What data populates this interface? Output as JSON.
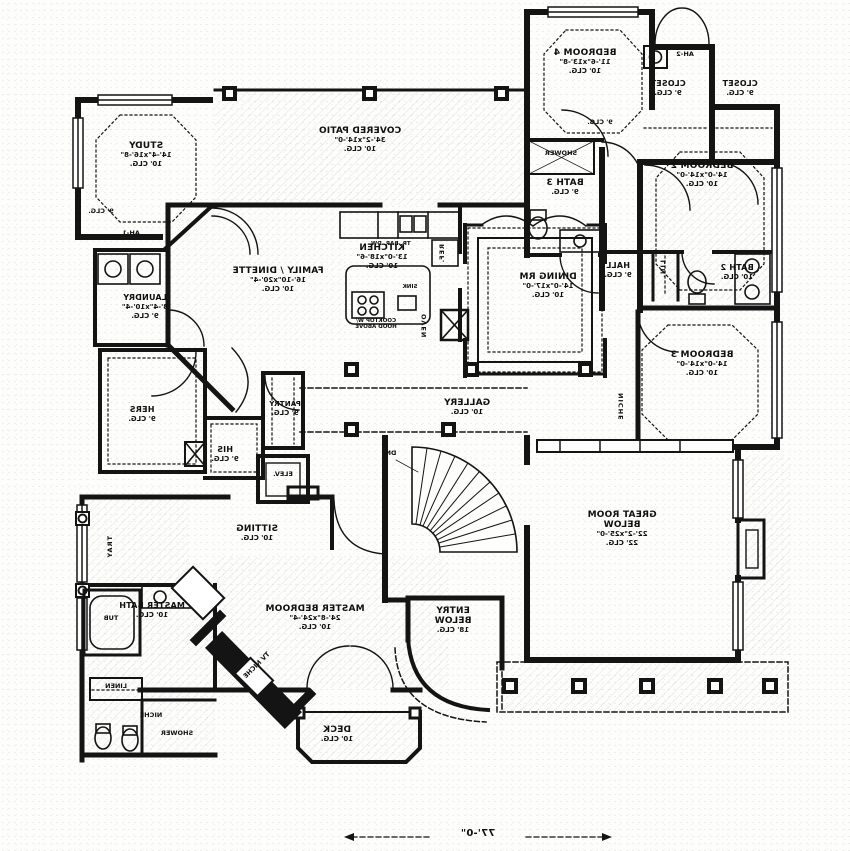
{
  "plan": {
    "rooms": [
      {
        "name": "BEDROOM 4",
        "size": "11'-6\"x13'-8\"",
        "clg": "10' CLG."
      },
      {
        "name": "CLOSET",
        "clg": "9' CLG."
      },
      {
        "name": "CLOSET",
        "clg": "9' CLG."
      },
      {
        "name": "AH-2"
      },
      {
        "name": "BEDROOM 2",
        "size": "14'-0\"x14'-0\"",
        "clg": "10' CLG."
      },
      {
        "name": "BATH 3",
        "clg": "9' CLG."
      },
      {
        "name": "BATH 2",
        "clg": "10' CLG."
      },
      {
        "name": "HALL",
        "clg": "9' CLG."
      },
      {
        "name": "BEDROOM 3",
        "size": "14'-0\"x14'-0\"",
        "clg": "10' CLG."
      },
      {
        "name": "DINING RM",
        "size": "14'-0\"x17'-0\"",
        "clg": "10' CLG."
      },
      {
        "name": "KITCHEN",
        "size": "13'-0\"x18'-6\"",
        "clg": "10' CLG."
      },
      {
        "name": "FAMILY / DINETTE",
        "size": "16'-10\"x20'-4\"",
        "clg": "10' CLG."
      },
      {
        "name": "COVERED PATIO",
        "size": "34'-2\"x14'-0\"",
        "clg": "10' CLG."
      },
      {
        "name": "STUDY",
        "size": "14'-4\"x16'-8\"",
        "clg": "10' CLG."
      },
      {
        "name": "LAUNDRY",
        "size": "8'-4\"x10'-4\"",
        "clg": "9' CLG."
      },
      {
        "name": "HERS",
        "clg": "9' CLG."
      },
      {
        "name": "HIS",
        "clg": "9' CLG."
      },
      {
        "name": "PANTRY",
        "clg": "9' CLG."
      },
      {
        "name": "GALLERY",
        "clg": "10' CLG."
      },
      {
        "name": "GREAT ROOM",
        "sub": "BELOW",
        "size": "22'-2\"x25'-0\"",
        "clg": "22' CLG."
      },
      {
        "name": "SITTING",
        "clg": "10' CLG."
      },
      {
        "name": "MASTER BEDROOM",
        "size": "24'-8\"x24'-4\"",
        "clg": "10' CLG."
      },
      {
        "name": "MASTER BATH",
        "clg": "10' CLG."
      },
      {
        "name": "ENTRY",
        "sub": "BELOW",
        "clg": "18' CLG."
      },
      {
        "name": "DECK",
        "clg": "10' CLG."
      }
    ],
    "fixtures": {
      "elev": "ELEV.",
      "dn": "DN",
      "shower_bath3": "SHOWER",
      "shower_master": "SHOWER",
      "tub": "TUB",
      "linen": "LINEN",
      "niche_master": "NICHE",
      "niche_hall": "NICHE",
      "tv_niche": "TV NICHE",
      "tray": "TRAY",
      "lin_closet": "LIN.",
      "oven": "OVEN",
      "ref": "REF.",
      "sink": "SINK",
      "cooktop_l1": "COOKTOP W/",
      "cooktop_l2": "HOOD ABOVE",
      "counter_appliances": "TR. BAR. DW.",
      "ah1": "AH-1",
      "clg9_hall": "9' CLG.",
      "clg9_study": "9' CLG."
    },
    "dimension": {
      "overall_width": "77'-0\""
    },
    "colors": {
      "ink": "#141414",
      "paper": "#fdfdfc"
    }
  }
}
